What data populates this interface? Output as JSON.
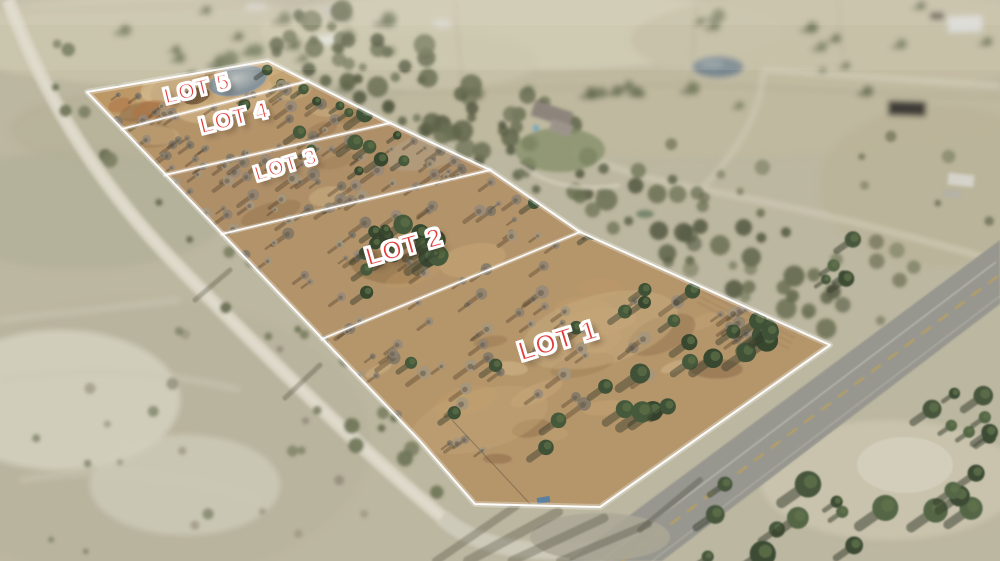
{
  "scene": {
    "type": "aerial drone photo of subdivided rural acreage",
    "label_color": "#e23c38",
    "boundary_color": "#ffffff"
  },
  "lots": [
    {
      "id": "lot-1",
      "label": "LOT 1"
    },
    {
      "id": "lot-2",
      "label": "LOT 2"
    },
    {
      "id": "lot-3",
      "label": "LOT 3"
    },
    {
      "id": "lot-4",
      "label": "LOT 4"
    },
    {
      "id": "lot-5",
      "label": "LOT 5"
    }
  ]
}
